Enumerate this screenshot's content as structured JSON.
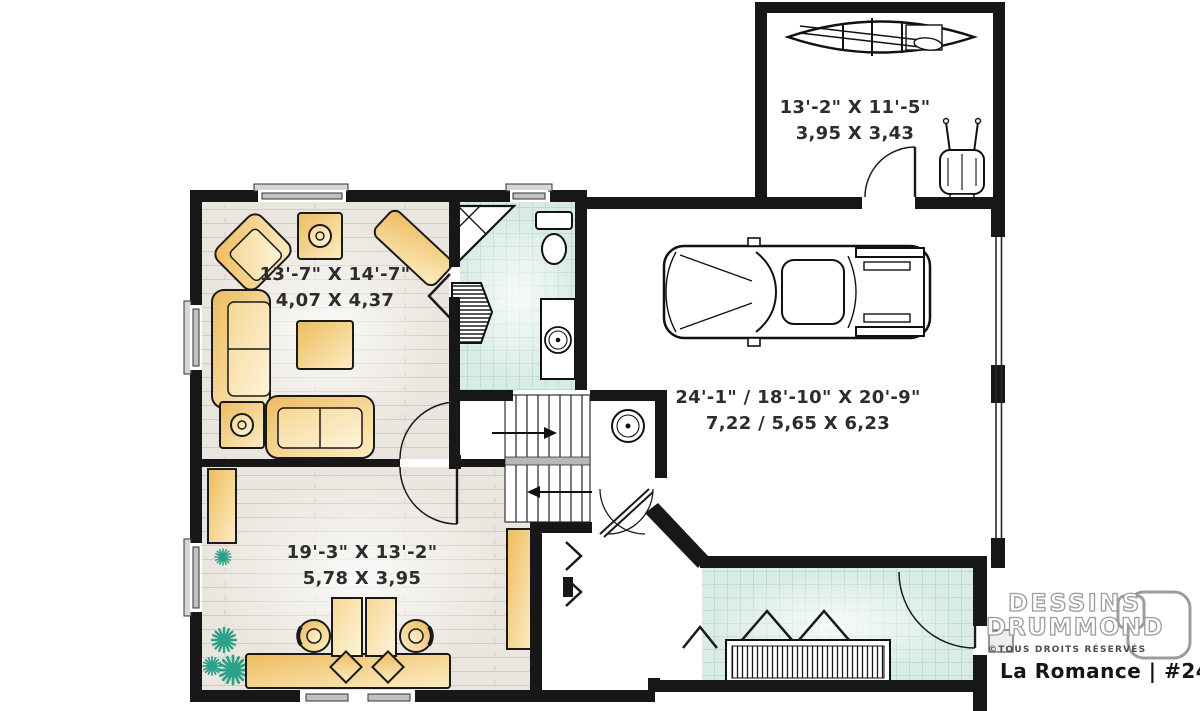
{
  "meta": {
    "type": "basement floor plan"
  },
  "brand": {
    "name_line1": "DESSINS",
    "name_line2": "DRUMMOND",
    "rights": "©TOUS DROITS RÉSERVÉS",
    "caption": "La Romance | #2480"
  },
  "rooms": {
    "storage": {
      "imperial": "13'-2\" X 11'-5\"",
      "metric": "3,95 X 3,43"
    },
    "family_room": {
      "imperial": "13'-7\" X 14'-7\"",
      "metric": "4,07 X 4,37"
    },
    "garage": {
      "imperial": "24'-1\" / 18'-10\" X 20'-9\"",
      "metric": "7,22 / 5,65 X 6,23"
    },
    "office": {
      "imperial": "19'-3\" X 13'-2\"",
      "metric": "5,78 X 3,95"
    }
  },
  "objects_depicted": [
    "canoe",
    "utility-cart",
    "pickup-truck",
    "corner-shower",
    "toilet",
    "vanity-sink",
    "water-heater",
    "staircase-with-arrows",
    "sofa",
    "loveseat",
    "corner-armchair",
    "console-bench",
    "coffee-table",
    "lamp-tables",
    "tall-cabinet",
    "bookshelf",
    "plants",
    "double-workstation-desk",
    "office-chairs",
    "closet-with-hanging-rod",
    "bifold-doors",
    "door-swings",
    "windows"
  ],
  "colors": {
    "wall": "#171717",
    "wood_floor": "#eae6df",
    "tile_floor": "#d8ebe4",
    "furniture_gold": "#f0c272",
    "plant_teal": "#2aa189",
    "logo_gray": "#9c9c9c",
    "caption_black": "#161616"
  }
}
